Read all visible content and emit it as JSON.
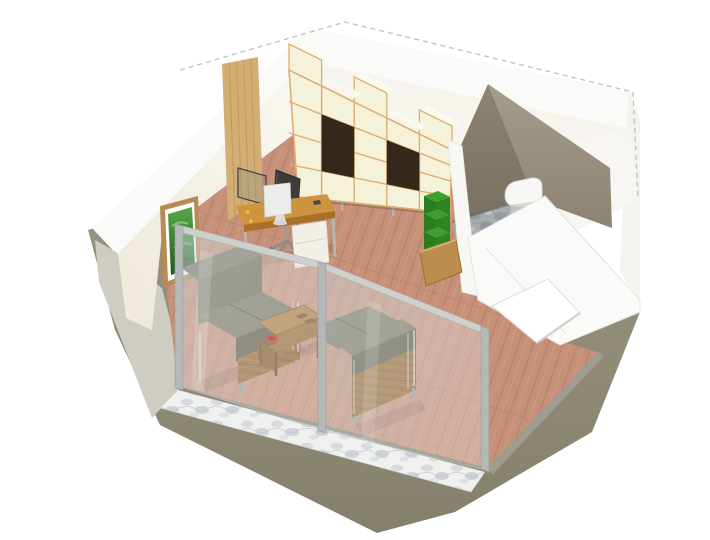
{
  "scene": {
    "title": "3D isometric cutaway floor plan render of a studio apartment",
    "view": "top-down dimetric cutaway, white background, dashed roof outline",
    "rooms": [
      {
        "name": "living-office-area",
        "floor": "light wood planks",
        "features": [
          "glass facade with two panels and three metal posts",
          "white marble threshold strip outside glass",
          "tan wood wall panel",
          "framed green plant picture"
        ]
      },
      {
        "name": "bathroom",
        "floor": "grey-blue stone tiles",
        "walls": "taupe plaster",
        "fixtures": [
          "wall-hung toilet"
        ]
      },
      {
        "name": "entry",
        "features": [
          "door opening in right wall"
        ]
      }
    ],
    "furniture": [
      "desk",
      "office-chair",
      "desktop-monitor",
      "desk-privacy-screen",
      "drawer-pedestal",
      "cube-bookshelf",
      "sofa-left",
      "sofa-right",
      "coffee-table",
      "red-bowl",
      "planter-with-green-bushes",
      "picture-frame",
      "toilet"
    ]
  },
  "colors": {
    "background": "#ffffff",
    "dash": "#c0c0c0",
    "olive_base": "#8d8974",
    "exterior_grey": "#cfccc3",
    "wall_white": "#fafaf8",
    "wall_cream": "#f6f3ea",
    "wood_panel": "#d2ae74",
    "floor_wood": "#c79179",
    "shelf_cream": "#f5f2da",
    "shelf_edge": "#ddae72",
    "shelf_dark": "#34281a",
    "bathroom_wall_dark": "#857d6c",
    "bathroom_wall_light": "#9c9383",
    "stone_floor": "#a7adaf",
    "marble_strip": "#efefed",
    "glass_tint": "#ccd4d8",
    "frame_metal": "#b4b8b7",
    "sofa_cushion": "#6f6958",
    "sofa_cushion_dark": "#5e5847",
    "sofa_cushion_top": "#7b7564",
    "sofa_wood": "#9a6833",
    "table_wood": "#b07e3f",
    "table_wood_dark": "#8a5c2a",
    "red_bowl": "#cf2f1f",
    "desk_wood": "#cf9440",
    "desk_pedestal": "#f1efe8",
    "monitor_white": "#ececea",
    "chair_dark": "#3c3c3a",
    "plant_green": "#3f9e2f",
    "plant_green_dark": "#2e8420",
    "planter_wood": "#bd8d4d",
    "toilet_white": "#f7f8f6"
  }
}
